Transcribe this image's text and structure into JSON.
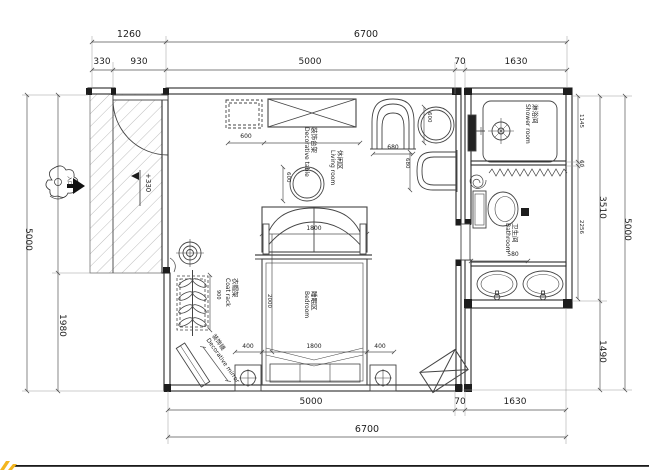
{
  "drawing": {
    "type": "floor plan"
  },
  "dims": {
    "top_row1": {
      "w1260": "1260",
      "w6700": "6700"
    },
    "top_row2": {
      "w330": "330",
      "w930": "930",
      "w5000": "5000",
      "w70": "70",
      "w1630": "1630"
    },
    "bottom_row1": {
      "w5000": "5000",
      "w70": "70",
      "w1630": "1630"
    },
    "bottom_row2": {
      "w6700": "6700"
    },
    "left": {
      "w5000": "5000",
      "w1980": "1980"
    },
    "right": {
      "w1145": "1145",
      "w60": "60",
      "w2256": "2256",
      "w3510": "3510",
      "w1490": "1490",
      "w5000": "5000"
    },
    "interior": {
      "cabinet_w": "600",
      "table_w": "600",
      "chair1_w": "680",
      "side_table_w": "600",
      "chair2_w": "680",
      "bed_head_w": "1800",
      "bed_len": "2000",
      "bed_foot_w": "1800",
      "left_gap": "400",
      "right_gap": "400",
      "coat_rack_h": "900",
      "bath_w": "580"
    },
    "floor_level": "+330"
  },
  "rooms": {
    "living": {
      "zh": "休闲区",
      "en": "Living room"
    },
    "bedroom": {
      "zh": "睡眠区",
      "en": "Bedroom"
    },
    "shower": {
      "zh": "淋浴间",
      "en": "Shower room"
    },
    "bathroom": {
      "zh": "卫生间",
      "en": "Bathroom"
    }
  },
  "items": {
    "decorative_table": {
      "zh": "装饰台架",
      "en": "Decorative table"
    },
    "coat_rack": {
      "zh": "衣帽架",
      "en": "Coat rack"
    },
    "decorative_mirror": {
      "zh": "装饰镜",
      "en": "Decorative mirror"
    },
    "entrance": {
      "zh": "入口"
    }
  },
  "colors": {
    "line": "#2b2b2b",
    "dim_line": "#555555",
    "hatch": "#b5b5b5",
    "accent_yellow": "#f3b61f"
  }
}
